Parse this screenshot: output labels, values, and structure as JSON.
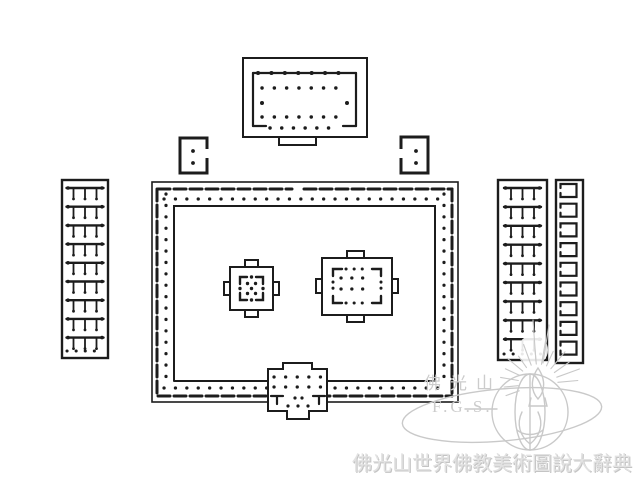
{
  "palette": {
    "ink": "#1c1c1c",
    "background": "#ffffff",
    "watermark_line": "#c9c9c9",
    "watermark_text": "#cccccc",
    "footer_text": "#e2e2e2"
  },
  "watermark": {
    "site_name": "佛光山",
    "abbreviation": "F.G.S."
  },
  "footer": {
    "title": "佛光山世界佛教美術圖說大辭典"
  }
}
